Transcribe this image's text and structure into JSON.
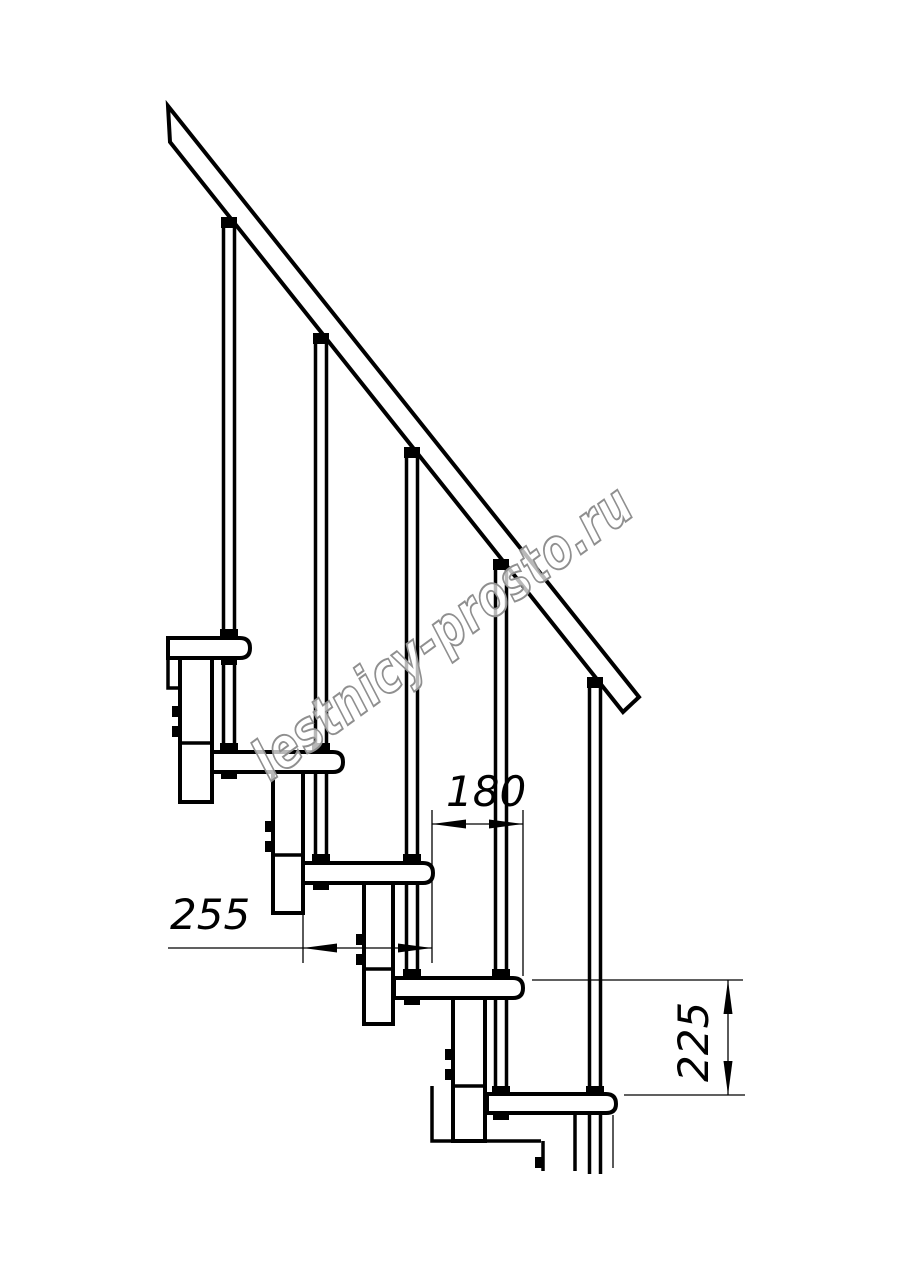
{
  "drawing": {
    "title_hint": "modular-staircase-side-view",
    "watermark": "lestnicy-prosto.ru",
    "dimensions": {
      "step_run": "180",
      "tread_depth": "255",
      "riser_height": "225"
    },
    "colors": {
      "line": "#000000",
      "background": "#ffffff",
      "watermark_fill": "#ffffff",
      "watermark_stroke": "#8f8f8f"
    },
    "steps_count": 5,
    "balusters_count": 5
  }
}
